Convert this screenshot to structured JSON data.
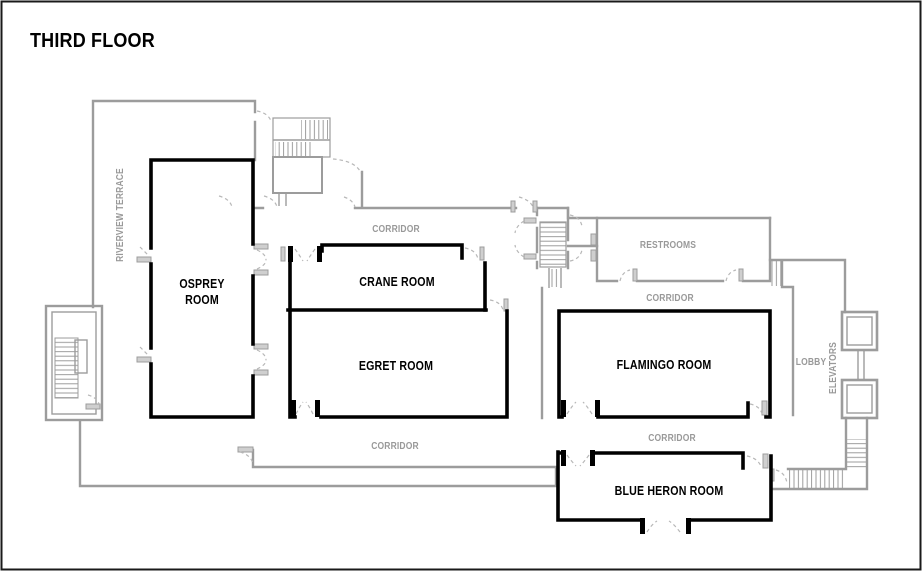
{
  "page": {
    "title": "THIRD FLOOR"
  },
  "rooms": {
    "osprey": {
      "line1": "OSPREY",
      "line2": "ROOM"
    },
    "crane": {
      "label": "CRANE ROOM"
    },
    "egret": {
      "label": "EGRET ROOM"
    },
    "flamingo": {
      "label": "FLAMINGO ROOM"
    },
    "blue_heron": {
      "label": "BLUE HERON ROOM"
    },
    "restrooms": {
      "label": "RESTROOMS"
    }
  },
  "areas": {
    "riverview_terrace": {
      "label": "RIVERVIEW TERRACE"
    },
    "lobby": {
      "label": "LOBBY"
    },
    "elevators": {
      "label": "ELEVATORS"
    },
    "corridors": [
      {
        "label": "CORRIDOR",
        "location": "upper-left"
      },
      {
        "label": "CORRIDOR",
        "location": "by-restrooms"
      },
      {
        "label": "CORRIDOR",
        "location": "lower-left"
      },
      {
        "label": "CORRIDOR",
        "location": "lower-right"
      }
    ]
  },
  "colors": {
    "wall_gray": "#9c9c9c",
    "wall_black": "#000000",
    "label_gray": "#999999",
    "door_arc": "#b8b8b8",
    "background": "#ffffff",
    "border": "#1a1a1a"
  }
}
